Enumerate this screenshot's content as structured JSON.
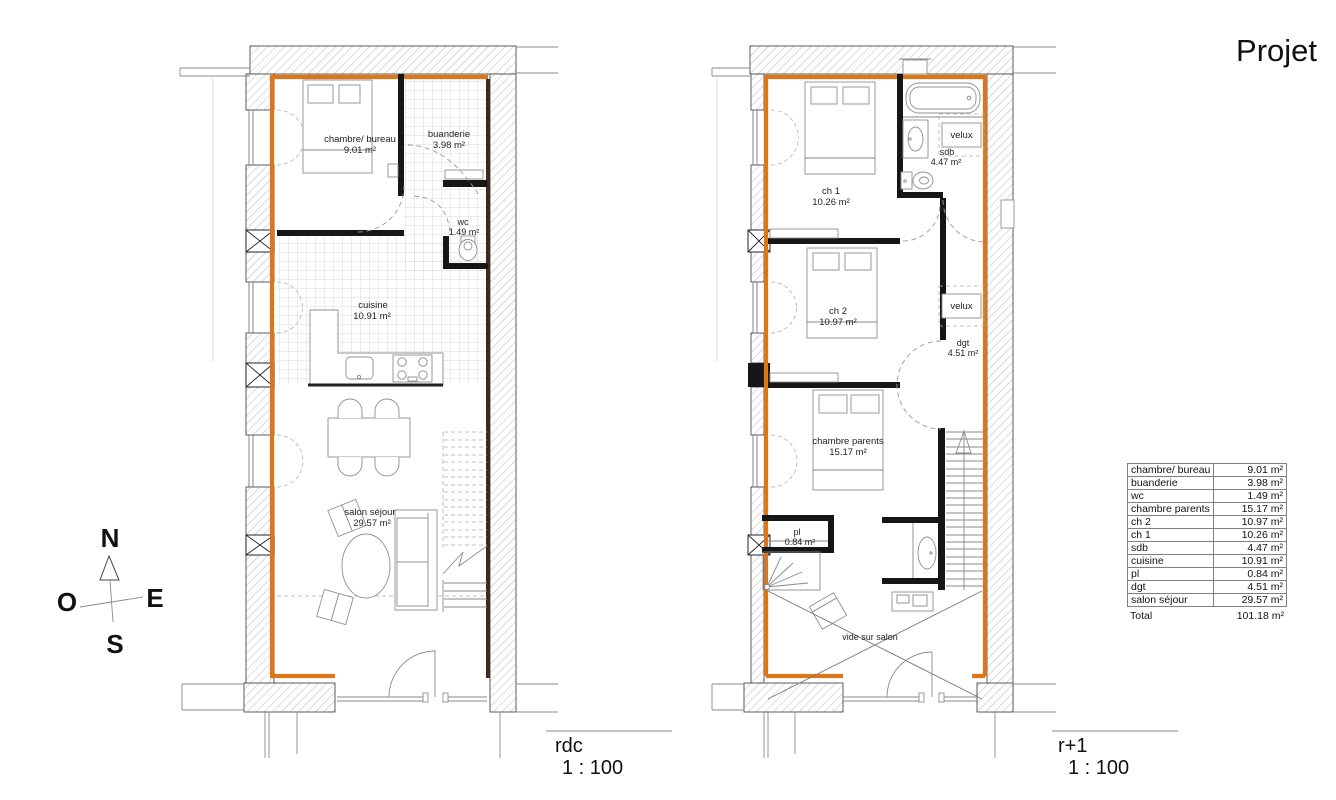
{
  "title": "Projet",
  "compass": {
    "north": "N",
    "south": "S",
    "east": "E",
    "west": "O"
  },
  "plans": {
    "rdc": {
      "name": "rdc",
      "scale": "1 : 100",
      "rooms": {
        "chambre_bureau": {
          "name": "chambre/ bureau",
          "area": "9.01 m²"
        },
        "buanderie": {
          "name": "buanderie",
          "area": "3.98 m²"
        },
        "wc": {
          "name": "wc",
          "area": "1.49 m²"
        },
        "cuisine": {
          "name": "cuisine",
          "area": "10.91 m²"
        },
        "salon_sejour": {
          "name": "salon séjour",
          "area": "29.57 m²"
        }
      }
    },
    "r1": {
      "name": "r+1",
      "scale": "1 : 100",
      "velux_label": "velux",
      "rooms": {
        "ch1": {
          "name": "ch 1",
          "area": "10.26 m²"
        },
        "sdb": {
          "name": "sdb",
          "area": "4.47 m²"
        },
        "ch2": {
          "name": "ch 2",
          "area": "10.97 m²"
        },
        "dgt": {
          "name": "dgt",
          "area": "4.51 m²"
        },
        "chambre_parents": {
          "name": "chambre parents",
          "area": "15.17 m²"
        },
        "pl": {
          "name": "pl",
          "area": "0.84 m²"
        },
        "vide": {
          "name": "vide sur salon"
        }
      }
    }
  },
  "legend_table": {
    "rows": [
      {
        "label": "chambre/ bureau",
        "value": "9.01 m²"
      },
      {
        "label": "buanderie",
        "value": "3.98 m²"
      },
      {
        "label": "wc",
        "value": "1.49 m²"
      },
      {
        "label": "chambre parents",
        "value": "15.17 m²"
      },
      {
        "label": "ch 2",
        "value": "10.97 m²"
      },
      {
        "label": "ch 1",
        "value": "10.26 m²"
      },
      {
        "label": "sdb",
        "value": "4.47 m²"
      },
      {
        "label": "cuisine",
        "value": "10.91 m²"
      },
      {
        "label": "pl",
        "value": "0.84 m²"
      },
      {
        "label": "dgt",
        "value": "4.51 m²"
      },
      {
        "label": "salon séjour",
        "value": "29.57 m²"
      }
    ],
    "total": {
      "label": "Total",
      "value": "101.18 m²"
    }
  },
  "colors": {
    "insulation_orange": "#dd7519",
    "hatch_gray": "#b8b8b8",
    "wall_black": "#161616"
  }
}
